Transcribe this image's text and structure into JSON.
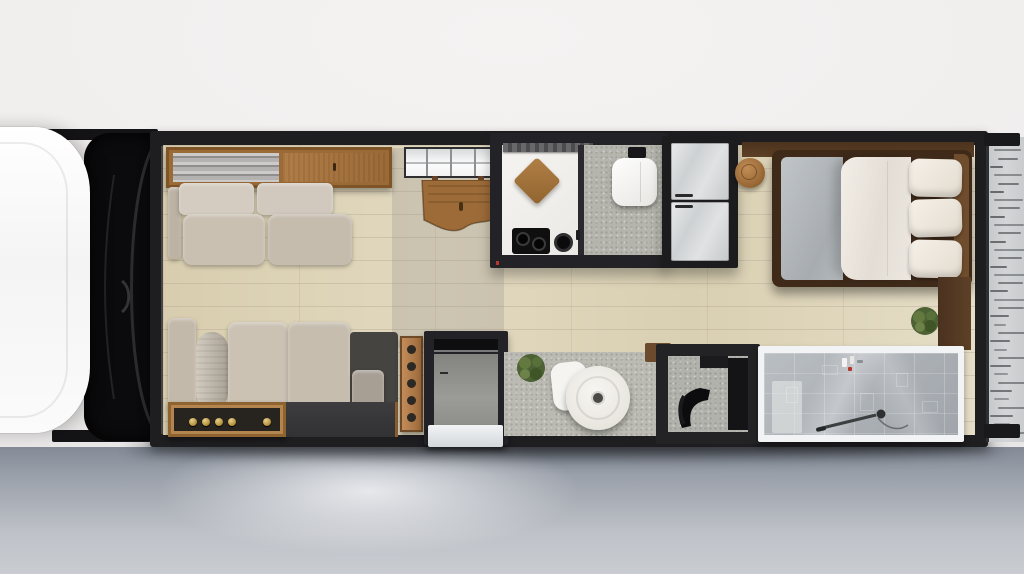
{
  "scene": {
    "type": "rv-motorhome-floor-plan-top-view",
    "rooms": [
      "truck-cab",
      "living-room",
      "galley-kitchen",
      "wet-bath",
      "entry",
      "cafe-corner",
      "desk-nook",
      "bedroom",
      "shower-room",
      "rear-deck"
    ],
    "furniture": [
      "cab-roof",
      "windshield",
      "overhead-shelf",
      "rolled-textiles",
      "overhead-cabinet",
      "sofa",
      "chaise-sofa",
      "bolster-pillow",
      "media-console",
      "window",
      "drop-leaf-table",
      "kitchen-counter",
      "range-hood",
      "cutting-board",
      "gas-cooktop",
      "trivet",
      "toilet",
      "cistern",
      "refrigerator",
      "wooden-stool",
      "bed",
      "gray-sheet",
      "white-duvet",
      "pillows",
      "potted-plant",
      "walnut-cabinet",
      "control-panel",
      "entry-door",
      "transom-window",
      "entry-step",
      "floor-mat",
      "cafe-table",
      "cafe-chair",
      "desk",
      "desk-chair",
      "wall-shelf",
      "shower-glass",
      "shower-wand",
      "toiletries",
      "rear-deck-boards"
    ]
  },
  "palette": {
    "bg_top": "#f1efee",
    "ground_dark": "#838a96",
    "ground_light": "#c9ccd1",
    "wall": "#1e1e21",
    "floor_wood": "#ddd3b5",
    "sofa_beige": "#c9c0b2",
    "wood_cabinet": "#a87944",
    "walnut": "#553a24",
    "bed_frame": "#3f2a19",
    "sheet_gray": "#b5babe",
    "duvet_white": "#ece7e0",
    "pillow_white": "#efe9df",
    "counter_white": "#f2f1ed",
    "bath_floor": "#b5b5ad",
    "mat_gray": "#bbbbb3",
    "steel": "#d9dbdc",
    "shower_tile": "#aab0b5",
    "frame_white": "#f2f3f5",
    "copper": "#b57e4e",
    "brass": "#c9a44a",
    "plant_green": "#5d7440",
    "accent_red": "#b8352c",
    "cab_white": "#fcfcfc",
    "glass_black": "#0b0b0d",
    "deck_gray": "#cbced0",
    "deck_stripe": "#54565a"
  },
  "counts": {
    "bed_pillows": 3,
    "copper_panel_knobs": 5,
    "window_mullions": 3,
    "deck_stripes": 36,
    "fridge_doors": 2
  },
  "positions": {
    "console_knob_x": [
      18,
      31,
      44,
      57,
      92
    ],
    "toiletry_items": [
      {
        "x": 78,
        "y": 5,
        "w": 5,
        "h": 9,
        "color": "#f4f3f1"
      },
      {
        "x": 86,
        "y": 3,
        "w": 4,
        "h": 8,
        "color": "#e8e7e4"
      },
      {
        "x": 84,
        "y": 14,
        "w": 4,
        "h": 4,
        "color": "#b8352c"
      },
      {
        "x": 93,
        "y": 7,
        "w": 6,
        "h": 3,
        "color": "#8d9093"
      }
    ],
    "tile_patches": [
      {
        "x": 22,
        "y": 34,
        "w": 12,
        "h": 16
      },
      {
        "x": 58,
        "y": 12,
        "w": 16,
        "h": 10
      },
      {
        "x": 96,
        "y": 40,
        "w": 14,
        "h": 18
      },
      {
        "x": 132,
        "y": 20,
        "w": 12,
        "h": 14
      },
      {
        "x": 158,
        "y": 48,
        "w": 16,
        "h": 12
      }
    ]
  }
}
